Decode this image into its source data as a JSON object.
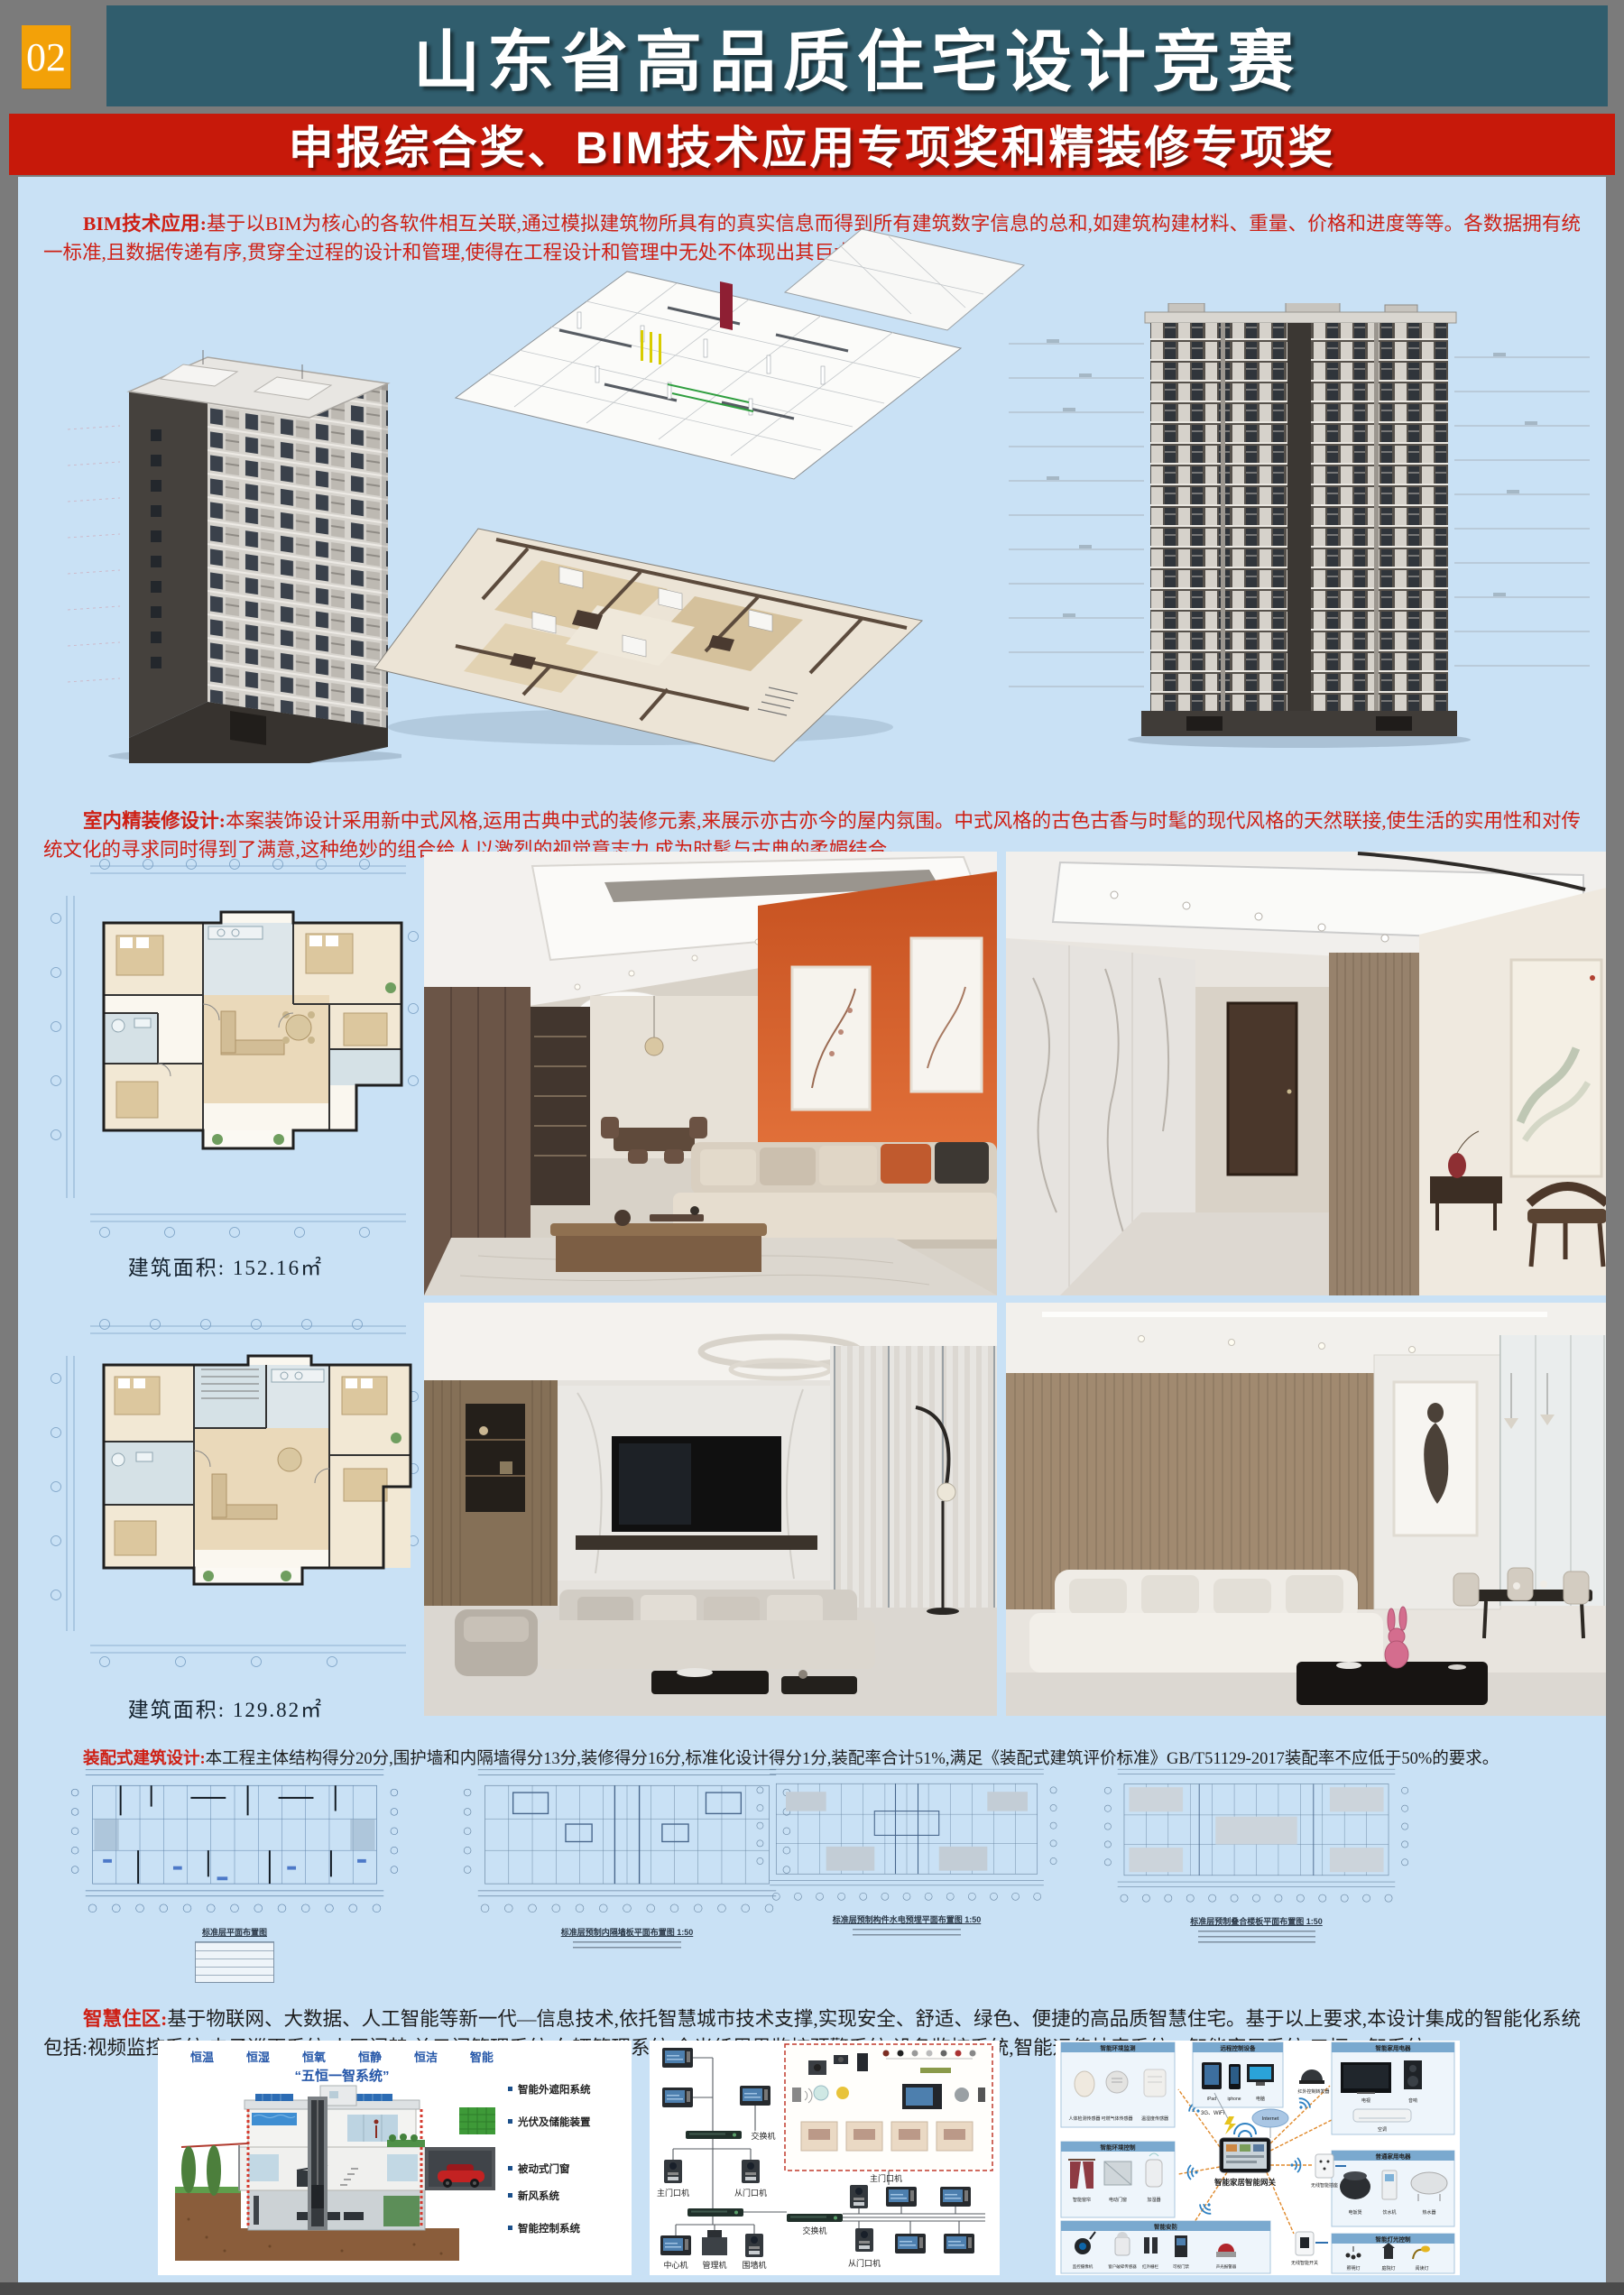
{
  "page": {
    "number": "02",
    "title": "山东省高品质住宅设计竞赛",
    "banner": "申报综合奖、BIM技术应用专项奖和精装修专项奖"
  },
  "paragraphs": {
    "bim_label": "BIM技术应用:",
    "bim_text": "基于以BIM为核心的各软件相互关联,通过模拟建筑物所具有的真实信息而得到所有建筑数字信息的总和,如建筑构建材料、重量、价格和进度等等。各数据拥有统一标准,且数据传递有序,贯穿全过程的设计和管理,使得在工程设计和管理中无处不体现出其巨大优势。",
    "interior_label": "室内精装修设计:",
    "interior_text": "本案装饰设计采用新中式风格,运用古典中式的装修元素,来展示亦古亦今的屋内氛围。中式风格的古色古香与时髦的现代风格的天然联接,使生活的实用性和对传统文化的寻求同时得到了满意,这种绝妙的组合给人以激烈的视觉意志力,成为时髦与古典的柔媚结合。",
    "prefab_label": "装配式建筑设计:",
    "prefab_text": "本工程主体结构得分20分,围护墙和内隔墙得分13分,装修得分16分,标准化设计得分1分,装配率合计51%,满足《装配式建筑评价标准》GB/T51129-2017装配率不应低于50%的要求。",
    "smart_label": "智慧住区:",
    "smart_text": "基于物联网、大数据、人工智能等新一代—信息技术,依托智慧城市技术支撑,实现安全、舒适、绿色、便捷的高品质智慧住宅。基于以上要求,本设计集成的智能化系统包括:视频监控系统,电子巡更系统,小区门禁,单元门管理系统,车辆管理系统,全光纤周界监控预警系统,设备监控系统,智能远传抄表系统、智能家居系统,五恒一智系统。"
  },
  "plans": {
    "area1": "建筑面积: 152.16㎡",
    "area2": "建筑面积: 129.82㎡",
    "strip_titles": [
      "标准层平面布置图",
      "标准层预制内隔墙板平面布置图 1:50",
      "标准层预制构件水电预埋平面布置图 1:50",
      "标准层预制叠合楼板平面布置图 1:50"
    ]
  },
  "five_constant": {
    "tags": [
      "恒温",
      "恒湿",
      "恒氧",
      "恒静",
      "恒洁",
      "智能"
    ],
    "title": "“五恒一智系统”",
    "callouts": [
      "智能外遮阳系统",
      "光伏及储能装置",
      "被动式门窗",
      "新风系统",
      "智能控制系统"
    ]
  },
  "intercom": {
    "switch": "交换机",
    "main_door": "主门口机",
    "sub_door": "从门口机",
    "center": "中心机",
    "manager": "管理机",
    "wall": "围墙机"
  },
  "smart_home": {
    "gateway": "智能家居智能网关",
    "net1": "3G、WiFi",
    "net2": "Internet",
    "relay": "红外控制转发器",
    "socket": "无线智能插座",
    "wswitch": "无线智能开关",
    "groups": [
      {
        "title": "智能环境监测",
        "items": [
          "人体检测传感器",
          "可燃气体传感器",
          "温湿度传感器"
        ]
      },
      {
        "title": "远程控制设备",
        "items": [
          "iPad",
          "iphone",
          "电脑"
        ]
      },
      {
        "title": "智能家用电器",
        "items": [
          "电视",
          "音响",
          "空调"
        ]
      },
      {
        "title": "智能环境控制",
        "items": [
          "智能窗帘",
          "电动门窗",
          "加湿器"
        ]
      },
      {
        "title": "普通家用电器",
        "items": [
          "电饭煲",
          "饮水机",
          "热水器"
        ]
      },
      {
        "title": "智能安防",
        "items": [
          "监控摄像机",
          "窗户破碎传感器",
          "红外栅栏",
          "可视门禁",
          "声光报警器"
        ]
      },
      {
        "title": "智能灯光控制",
        "items": [
          "照明灯",
          "庭院灯",
          "阅读灯"
        ]
      }
    ]
  },
  "colors": {
    "teal_header": "#305d6d",
    "red_banner": "#c7190a",
    "orange_badge": "#f3a108",
    "bg_blue": "#c9e1f5",
    "accent_orange_wall": "#d2602c"
  }
}
